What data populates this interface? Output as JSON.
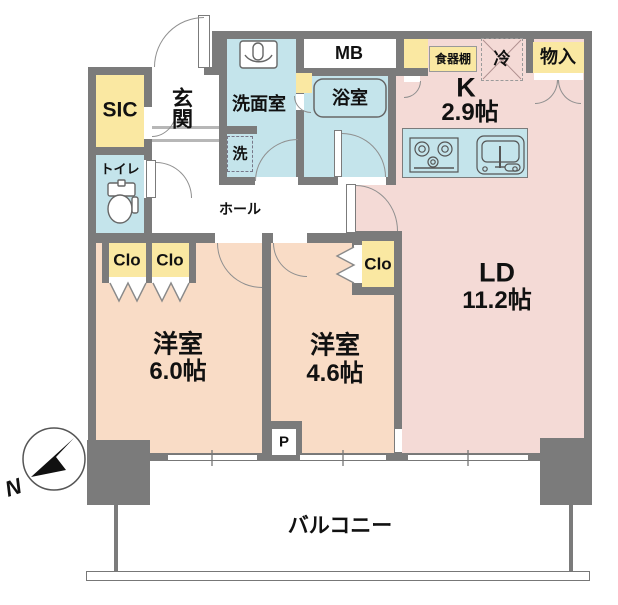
{
  "title": "2LDK apartment floor plan",
  "colors": {
    "wall": "#7b7b7b",
    "yellow": "#fae8a2",
    "blue": "#c4e4eb",
    "pink": "#f4dad6",
    "peach": "#f9dcc6"
  },
  "rooms": {
    "sic": {
      "label": "SIC"
    },
    "entrance": {
      "label": "玄関"
    },
    "toilet": {
      "label": "トイレ"
    },
    "washroom": {
      "label": "洗面室"
    },
    "washer": {
      "label": "洗"
    },
    "meter_box": {
      "label": "MB"
    },
    "bath": {
      "label": "浴室"
    },
    "hall": {
      "label": "ホール"
    },
    "kitchen": {
      "label": "K",
      "size": "2.9帖"
    },
    "cupboard": {
      "label": "食器棚"
    },
    "fridge": {
      "label": "冷"
    },
    "storage": {
      "label": "物入"
    },
    "living_dining": {
      "label": "LD",
      "size": "11.2帖"
    },
    "bedroom_1": {
      "label": "洋室",
      "size": "6.0帖"
    },
    "bedroom_2": {
      "label": "洋室",
      "size": "4.6帖"
    },
    "closet_1": {
      "label": "Clo"
    },
    "closet_2": {
      "label": "Clo"
    },
    "closet_3": {
      "label": "Clo"
    },
    "pipe_space": {
      "label": "P"
    },
    "balcony": {
      "label": "バルコニー"
    }
  },
  "compass": {
    "north_label": "N"
  }
}
